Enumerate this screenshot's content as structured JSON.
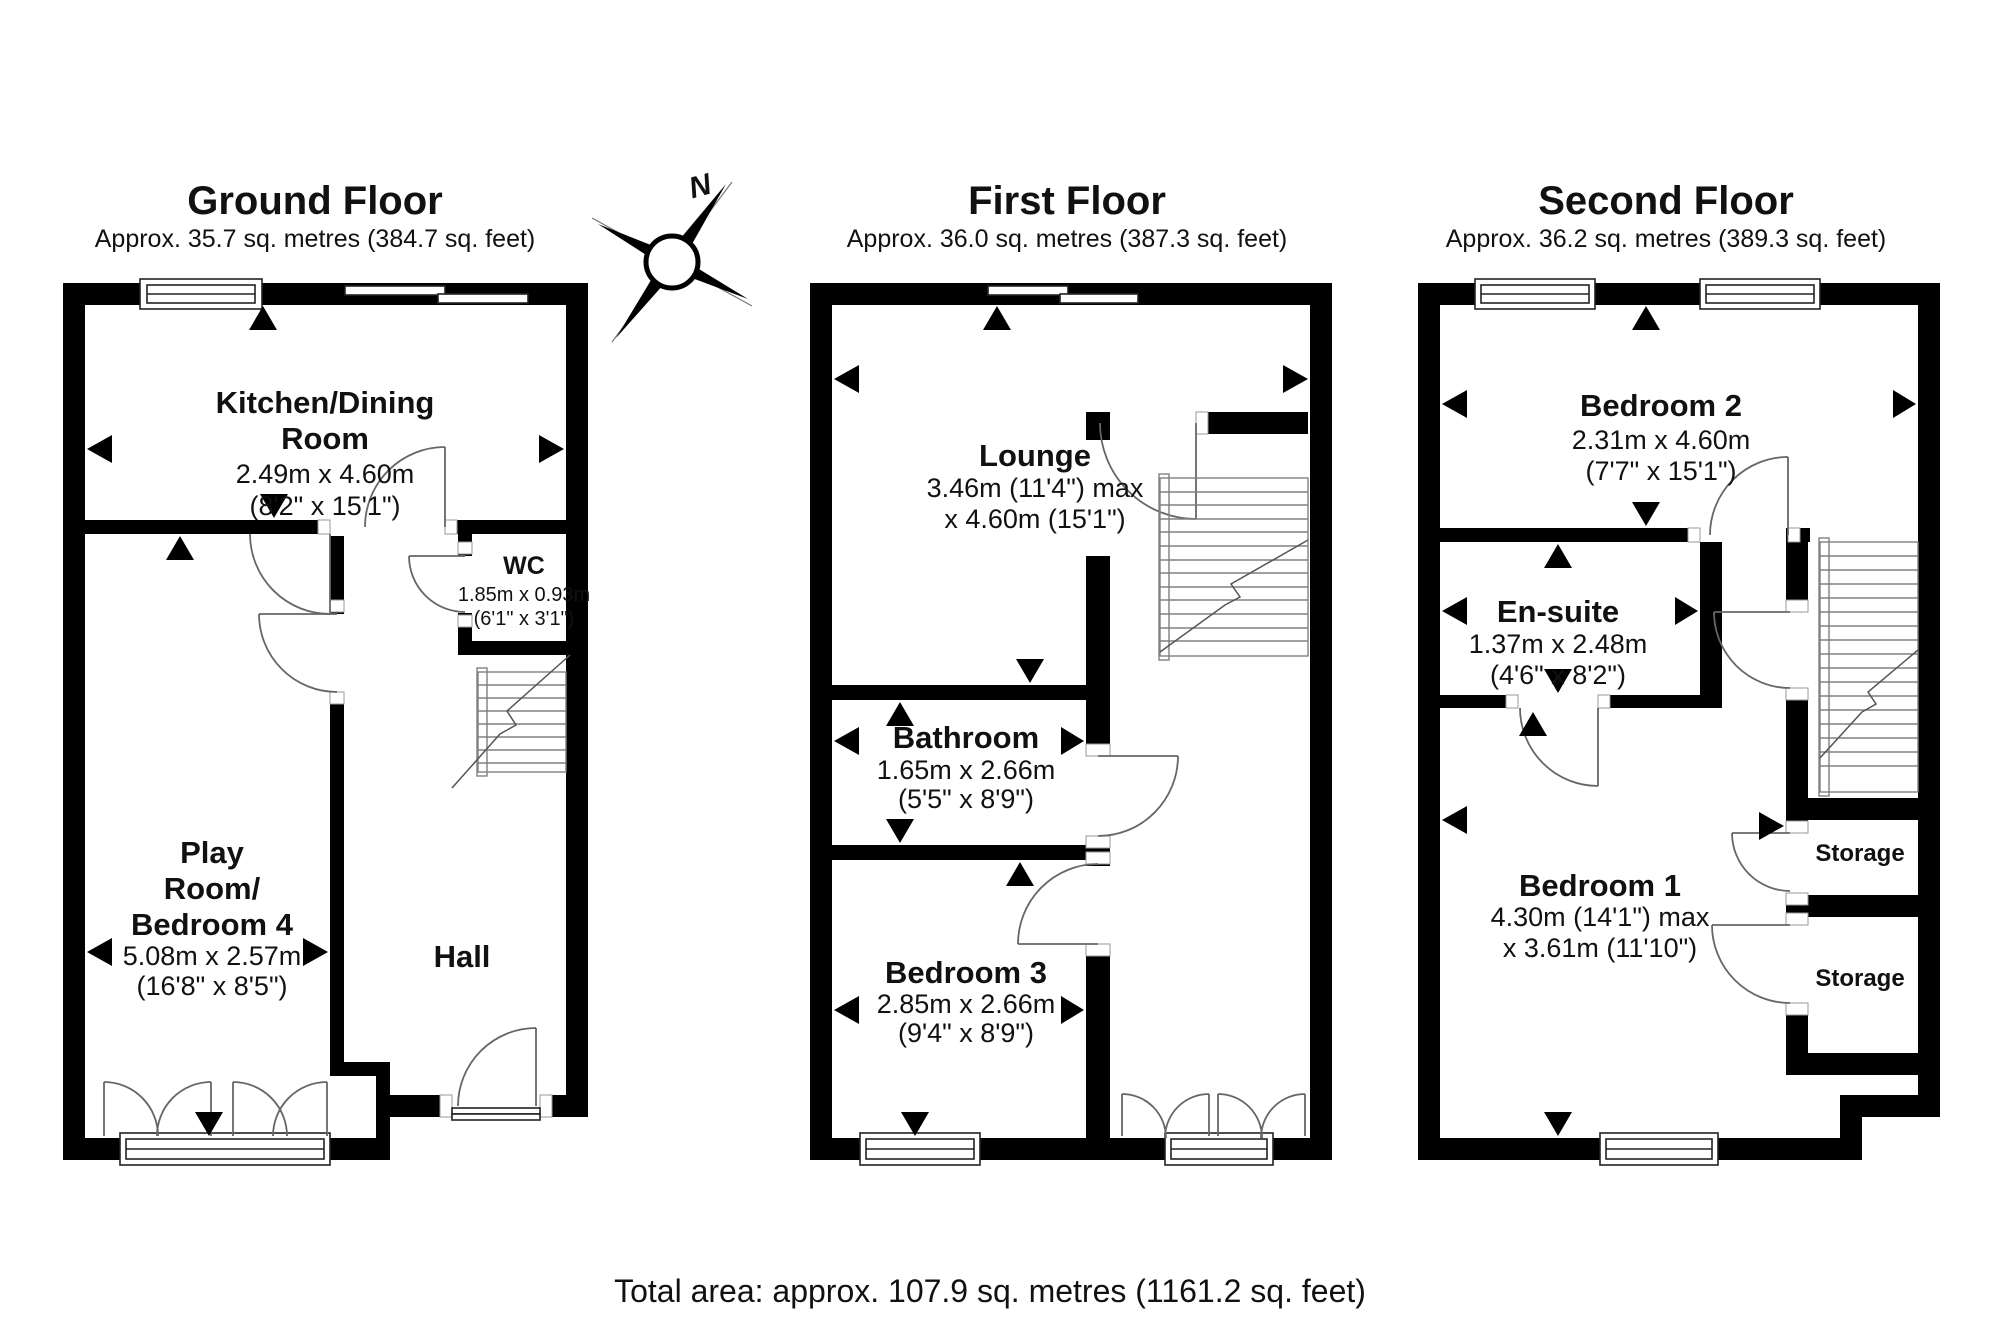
{
  "colors": {
    "walls": "#000000",
    "background": "#ffffff",
    "text": "#111111"
  },
  "compass": {
    "north_label": "N"
  },
  "footer": {
    "total_area": "Total area: approx. 107.9 sq. metres (1161.2 sq. feet)"
  },
  "floors": {
    "ground": {
      "title": "Ground Floor",
      "subtitle": "Approx. 35.7 sq. metres (384.7 sq. feet)",
      "rooms": {
        "kitchen": {
          "name_line1": "Kitchen/Dining",
          "name_line2": "Room",
          "dims_metric": "2.49m x 4.60m",
          "dims_imperial": "(8'2\" x 15'1\")"
        },
        "wc": {
          "name": "WC",
          "dims_metric": "1.85m x 0.93m",
          "dims_imperial": "(6'1\" x 3'1\")"
        },
        "playroom": {
          "name_line1": "Play",
          "name_line2": "Room/",
          "name_line3": "Bedroom 4",
          "dims_metric": "5.08m x 2.57m",
          "dims_imperial": "(16'8\" x 8'5\")"
        },
        "hall": {
          "name": "Hall"
        }
      }
    },
    "first": {
      "title": "First Floor",
      "subtitle": "Approx. 36.0 sq. metres (387.3 sq. feet)",
      "rooms": {
        "lounge": {
          "name": "Lounge",
          "dims_line1": "3.46m (11'4\") max",
          "dims_line2": "x 4.60m (15'1\")"
        },
        "bathroom": {
          "name": "Bathroom",
          "dims_metric": "1.65m x 2.66m",
          "dims_imperial": "(5'5\" x 8'9\")"
        },
        "bedroom3": {
          "name": "Bedroom 3",
          "dims_metric": "2.85m x 2.66m",
          "dims_imperial": "(9'4\" x 8'9\")"
        }
      }
    },
    "second": {
      "title": "Second Floor",
      "subtitle": "Approx. 36.2 sq. metres (389.3 sq. feet)",
      "rooms": {
        "bedroom2": {
          "name": "Bedroom 2",
          "dims_metric": "2.31m x 4.60m",
          "dims_imperial": "(7'7\" x 15'1\")"
        },
        "ensuite": {
          "name": "En-suite",
          "dims_metric": "1.37m x 2.48m",
          "dims_imperial": "(4'6\" x 8'2\")"
        },
        "bedroom1": {
          "name": "Bedroom 1",
          "dims_line1": "4.30m (14'1\") max",
          "dims_line2": "x 3.61m (11'10\")"
        },
        "storage_upper": {
          "name": "Storage"
        },
        "storage_lower": {
          "name": "Stor​age"
        }
      }
    }
  }
}
